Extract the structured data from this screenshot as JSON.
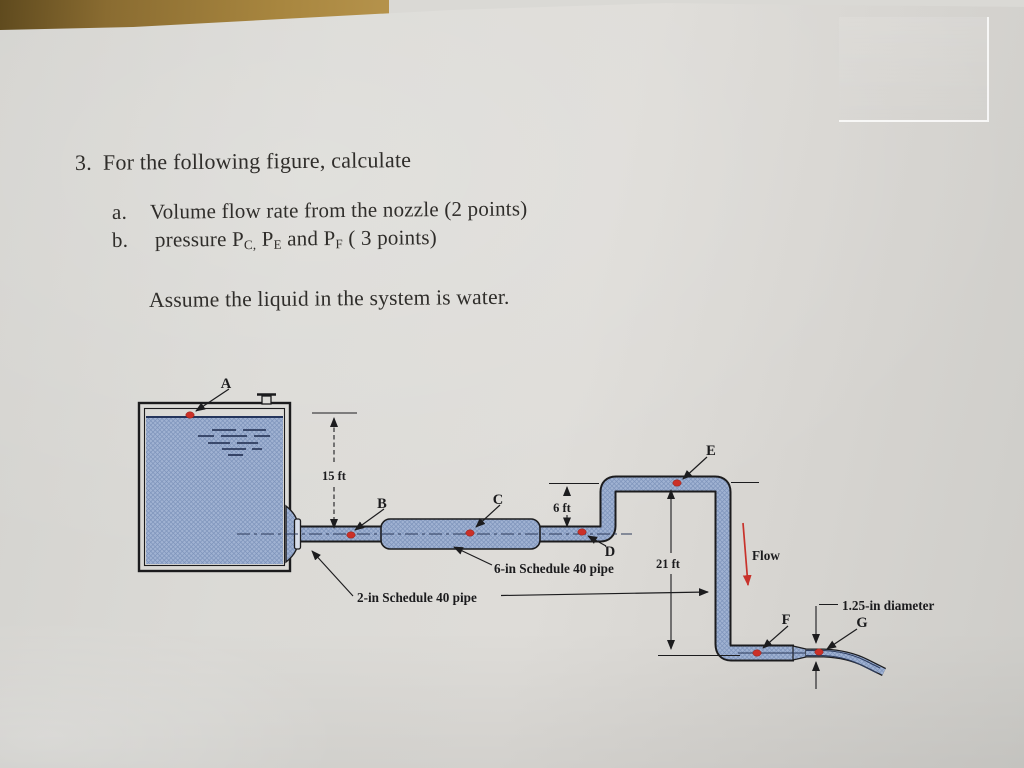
{
  "page": {
    "problem_number": "3.",
    "problem_title": "For the following figure, calculate",
    "item_a_label": "a.",
    "item_a_text": "Volume flow rate from the nozzle (2 points)",
    "item_b_label": "b.",
    "item_b": {
      "p1": "pressure P",
      "s1": "C,",
      "p2": " P",
      "s2": "E",
      "p3": " and P",
      "s3": "F",
      "p4": " ( 3 points)"
    },
    "assumption": "Assume the liquid in the system is water."
  },
  "figure": {
    "points": {
      "a": "A",
      "b": "B",
      "c": "C",
      "d": "D",
      "e": "E",
      "f": "F",
      "g": "G"
    },
    "dimensions": {
      "tank_head": "15 ft",
      "riser_height": "6 ft",
      "drop_height": "21 ft",
      "nozzle_diameter": "1.25-in diameter"
    },
    "labels": {
      "flow": "Flow",
      "pipe_6in": "6-in Schedule 40 pipe",
      "pipe_2in": "2-in Schedule 40 pipe"
    },
    "colors": {
      "pipe_fill": "#a0b2d2",
      "pipe_hatch": "#7e94bb",
      "outline": "#1c1c1e",
      "accent_red": "#c23525",
      "dot_red": "#cb3028",
      "centerline_navy": "#2c3a5a",
      "paper": "#d7d6d2",
      "wood": "#a8863f"
    }
  }
}
